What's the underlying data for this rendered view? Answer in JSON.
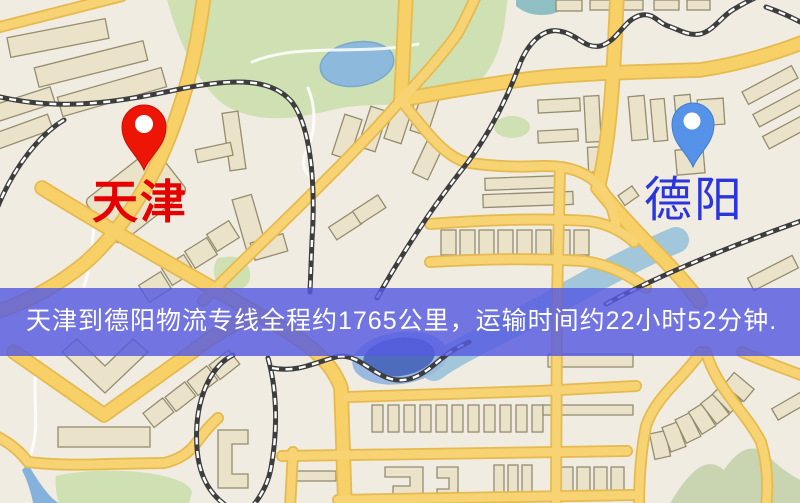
{
  "origin": {
    "name": "天津",
    "pin_color": "#ec1506",
    "label_color": "#e60000"
  },
  "destination": {
    "name": "德阳",
    "pin_color": "#5692e8",
    "label_color": "#2a35dd"
  },
  "banner": {
    "text": "天津到德阳物流专线全程约1765公里，运输时间约22小时52分钟.",
    "bg_color": "rgba(86,90,224,0.82)",
    "text_color": "#ffffff",
    "distance_km": "1765",
    "duration": "22小时52分钟"
  },
  "map_colors": {
    "land": "#f0ece1",
    "road": "#f7d068",
    "park": "#cfe0b3",
    "water": "#85b2da",
    "railway": "#3d3d3d",
    "building_fill": "#eae2c9",
    "building_stroke": "#958d6e"
  }
}
